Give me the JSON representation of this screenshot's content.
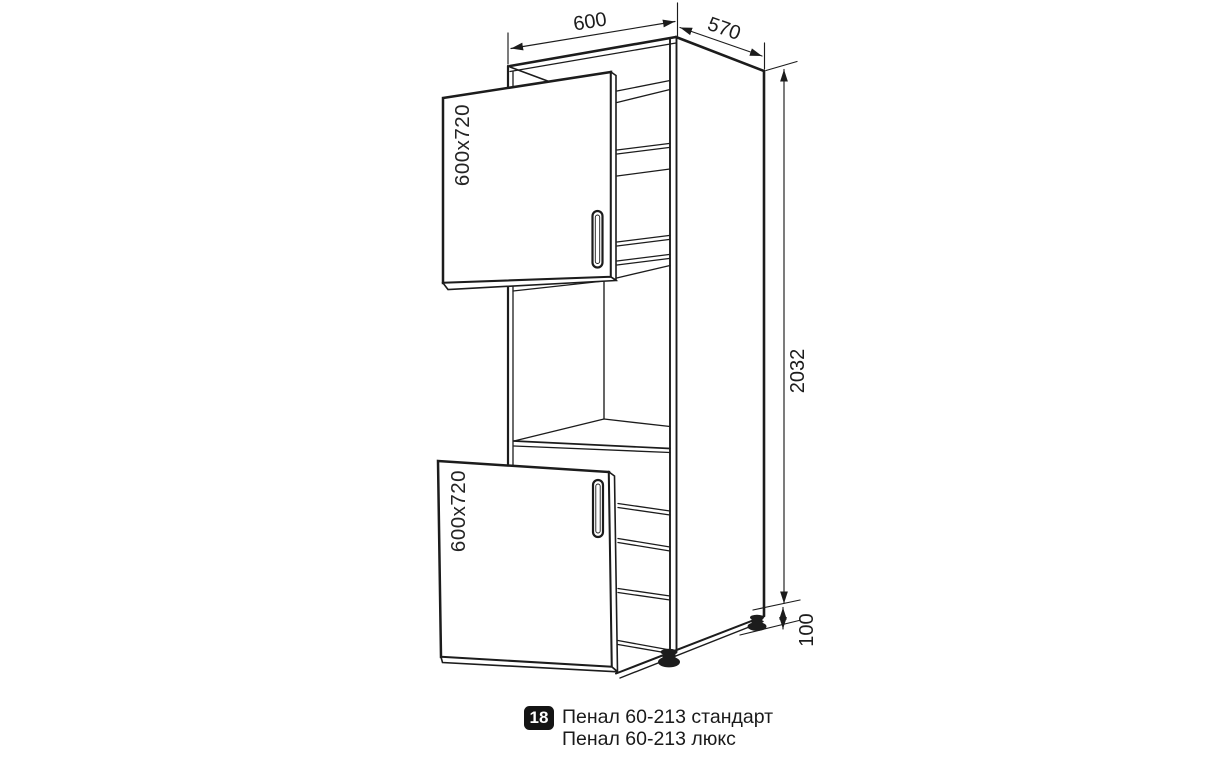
{
  "drawing_title": "tall-cabinet-technical-drawing",
  "dimensions": {
    "width_top_mm": "600",
    "depth_top_mm": "570",
    "height_right_mm": "2032",
    "legs_height_mm": "100"
  },
  "doors": {
    "upper_label": "600x720",
    "lower_label": "600x720"
  },
  "caption": {
    "index_badge": "18",
    "line1": "Пенал 60-213 стандарт",
    "line2": "Пенал 60-213 люкс"
  },
  "colors": {
    "line": "#1c1c1c",
    "bg": "#ffffff",
    "badge_bg": "#141414",
    "badge_text": "#ffffff"
  }
}
